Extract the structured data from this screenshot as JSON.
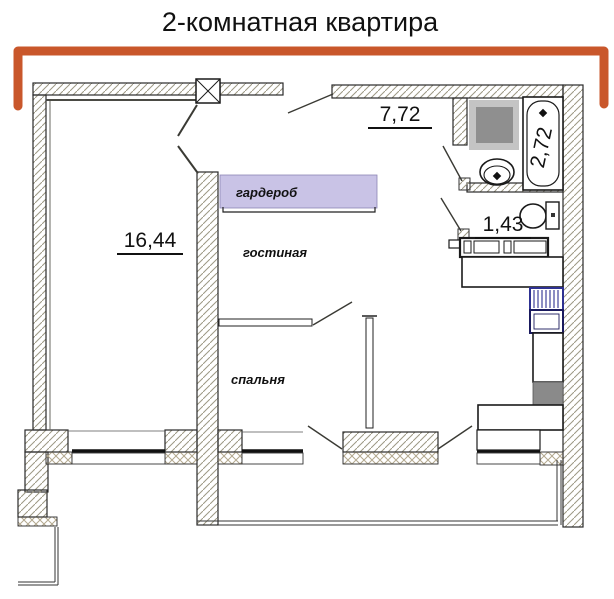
{
  "title": "2-комнатная квартира",
  "colors": {
    "bracket": "#c9572b",
    "wardrobe_fill": "#c9c3e6",
    "hatch_line": "#9c9884",
    "crosshatch_line": "#b3a88e",
    "washer_outer": "#c4c4c4",
    "washer_inner": "#8f8f8f",
    "stove_gray": "#8a8a8a",
    "fridge_blue": "#2e3192",
    "line_black": "#1a1a1a"
  },
  "rooms": {
    "room_main": {
      "area": "16,44"
    },
    "hall": {
      "area": "7,72"
    },
    "bath": {
      "area": "2,72"
    },
    "wc": {
      "area": "1,43"
    },
    "wardrobe": {
      "label": "гардероб"
    },
    "living": {
      "label": "гостиная"
    },
    "bedroom": {
      "label": "спальня"
    }
  }
}
